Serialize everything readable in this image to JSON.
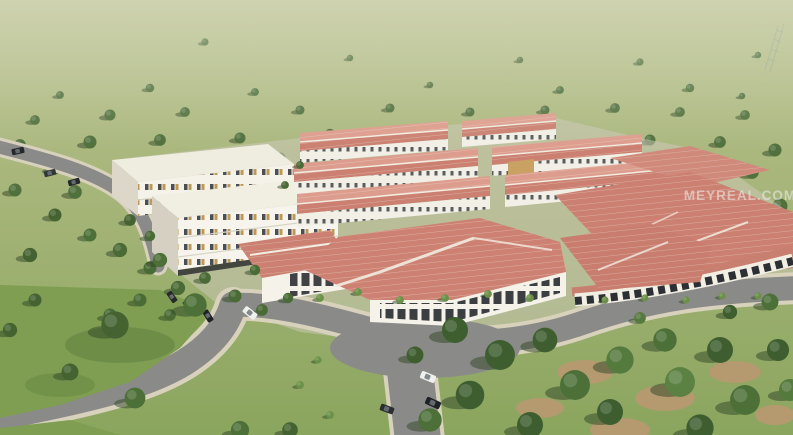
{
  "scene": {
    "watermark": "MEYREAL.COM"
  },
  "colors": {
    "field_top": "#b9c08f",
    "field_mid": "#a6b579",
    "field_low": "#8aa55e",
    "lawn": "#7f9e52",
    "tree": "#50703c",
    "tree_dark": "#3e5e2f",
    "tree_bright": "#6b9148",
    "shadow": "#2f4526",
    "roof_red": "#cb8071",
    "roof_red_light": "#dd9d8e",
    "ridge_white": "#f2ece1",
    "wall_white": "#f4f2e9",
    "wall_shade": "#dcd7c8",
    "road": "#8a8a88",
    "sidewalk": "#d8d2bc",
    "storefront": "#2c2f33",
    "window_dark": "#383d43",
    "accent_tan": "#b98f42",
    "ground_pad": "#cfcabb",
    "dirt": "#b49a6e",
    "car_white": "#eef0ee",
    "car_dark": "#26292c",
    "watermark_color": "#f0f0ee"
  }
}
